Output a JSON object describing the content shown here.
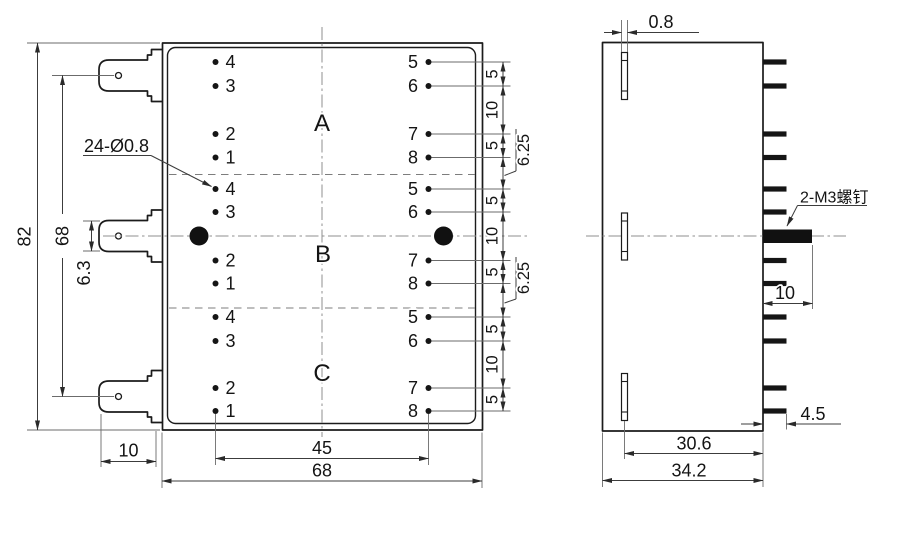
{
  "front_view": {
    "hole_callout": "24-Ø0.8",
    "sections": [
      {
        "label": "A",
        "left": [
          "4",
          "3",
          "2",
          "1"
        ],
        "right": [
          "5",
          "6",
          "7",
          "8"
        ]
      },
      {
        "label": "B",
        "left": [
          "4",
          "3",
          "2",
          "1"
        ],
        "right": [
          "5",
          "6",
          "7",
          "8"
        ]
      },
      {
        "label": "C",
        "left": [
          "4",
          "3",
          "2",
          "1"
        ],
        "right": [
          "5",
          "6",
          "7",
          "8"
        ]
      }
    ],
    "dims": {
      "overall_height": "82",
      "tab_pitch": "68",
      "tab_width": "6.3",
      "tab_length": "10",
      "pin_row_span": "45",
      "overall_width": "68",
      "pin_pitch_chain": [
        "5",
        "10",
        "5",
        "5",
        "10",
        "5",
        "5",
        "10",
        "5"
      ],
      "section_gap": "6.25"
    }
  },
  "side_view": {
    "screw_callout": "2-M3螺钉",
    "dims": {
      "tab_thickness": "0.8",
      "screw_thread_length": "10",
      "pin_length": "4.5",
      "tab_to_back": "30.6",
      "overall_depth": "34.2"
    }
  },
  "colors": {
    "line": "#1b1b1b",
    "dimension": "#3c3c3c",
    "centerline": "#8f8f8f",
    "background": "#ffffff"
  }
}
